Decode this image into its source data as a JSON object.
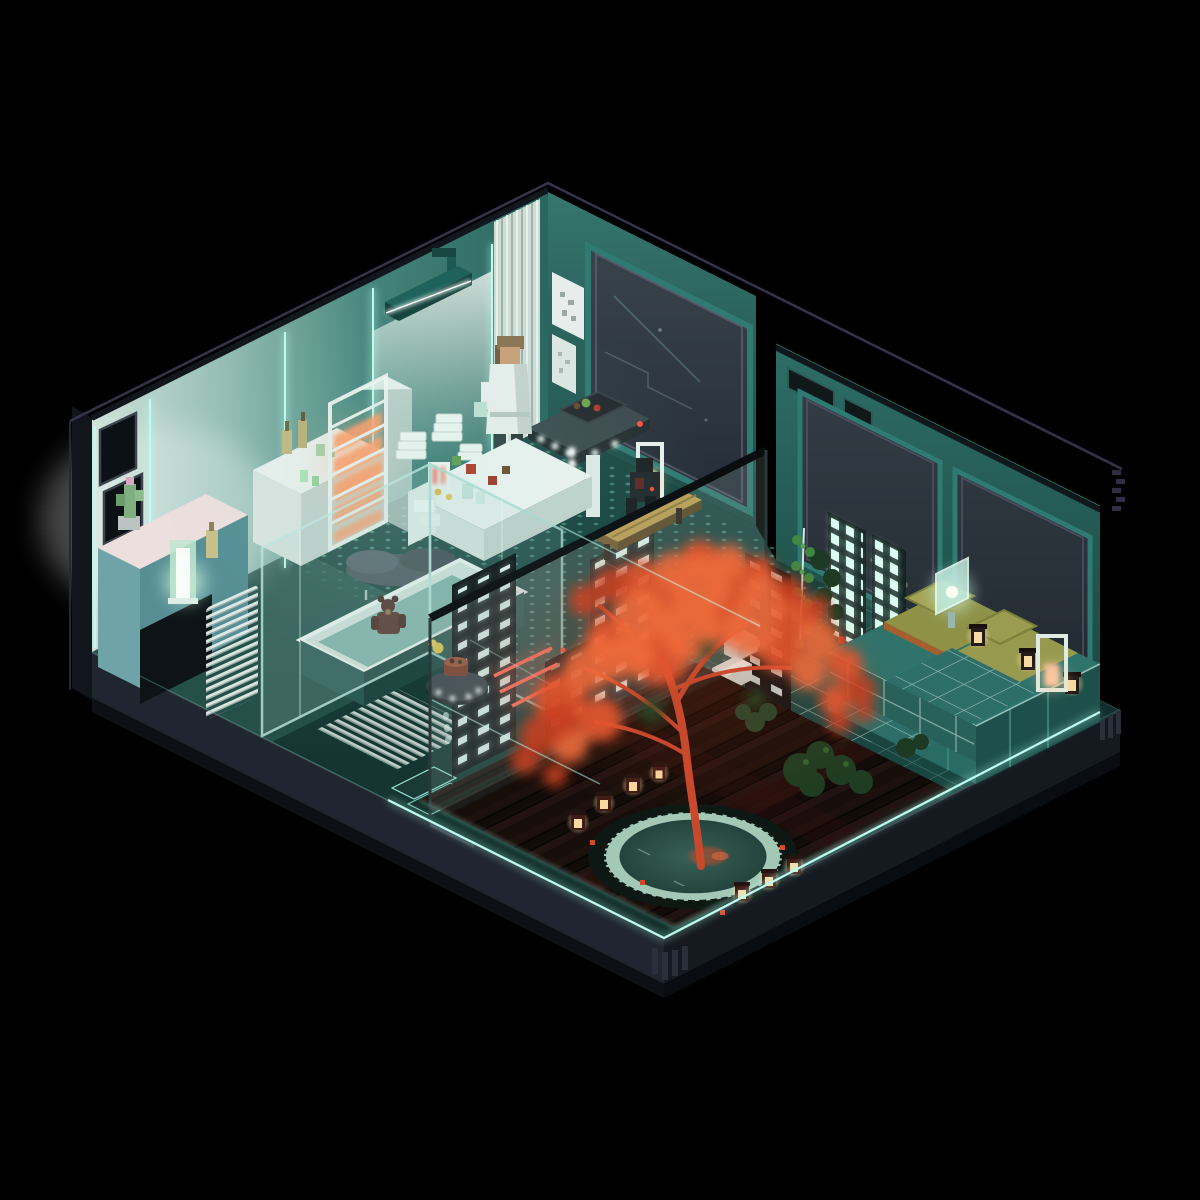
{
  "scene": {
    "type": "voxel-isometric-diorama",
    "subject": "Night-time voxel art diorama of a futuristic Japanese-style studio apartment with bathroom, kitchenette, inner courtyard with red maple tree over a round pond, and a bedroom, all rimmed with cyan neon on a black void",
    "style": "voxel art, neon-noir teal palette, isometric cutaway",
    "rooms": [
      {
        "name": "bathroom",
        "objects": [
          "rain-shower-head",
          "fluted-column",
          "glass-wet-room",
          "rain-cloud-over-bathtub",
          "teddy-bear-in-tub",
          "rubber-duck",
          "towel-stacks",
          "orange-glow-shelf-tower",
          "toiletry-bottles",
          "vanity-counter",
          "cactus-plant",
          "green-glass-lamp",
          "white-slat-panel",
          "neon-wall-seams"
        ]
      },
      {
        "name": "kitchenette",
        "objects": [
          "white-counter",
          "food-items",
          "small-appliance",
          "hover-console-table",
          "robed-resident-figure",
          "glowing-pill-column",
          "wall-art-frames",
          "picture-window"
        ]
      },
      {
        "name": "courtyard",
        "objects": [
          "red-maple-tree",
          "round-pond",
          "wood-plank-deck",
          "cube-lanterns",
          "tall-white-lantern",
          "garden-bench",
          "seated-figure",
          "step-stool",
          "shrubs",
          "ivy-vine",
          "hover-tray-with-bowl",
          "slat-screens",
          "red-neon-sign",
          "smoked-glass-partition",
          "neon-deck-rim"
        ]
      },
      {
        "name": "bedroom",
        "objects": [
          "platform-bed",
          "olive-mattresses",
          "pillows",
          "grid-pattern-blanket",
          "glass-bedside-lamp",
          "candle-lanterns",
          "floor-lantern",
          "lit-shoji-screens",
          "corner-windows",
          "dark-ivy"
        ]
      }
    ],
    "palette": {
      "background": "#000000",
      "wall_teal": "#2e6e67",
      "wall_light": "#c6ddd6",
      "wall_dark": "#1d4b46",
      "window_glass": "#2e3840",
      "neon_cyan": "#bdfcf0",
      "neon_red": "#ff6a55",
      "maple_red": "#e0502c",
      "shelf_glow_orange": "#ffac78",
      "lantern_warm": "#f7d9a2",
      "bed_olive": "#8f9147",
      "bed_teal": "#2a6b64",
      "deck_wood": "#170e0b",
      "pond_water": "#2e5048",
      "pond_rim": "#a3c8b6",
      "base_slate": "#232a34",
      "outline": "#3b3650"
    },
    "lighting": [
      "cyan-neon-wall-seams",
      "cyan-neon-deck-rim",
      "warm-lantern-glow",
      "green-glass-lamp-glow",
      "orange-shelf-glow",
      "red-neon-sign",
      "white-shower-light"
    ]
  }
}
